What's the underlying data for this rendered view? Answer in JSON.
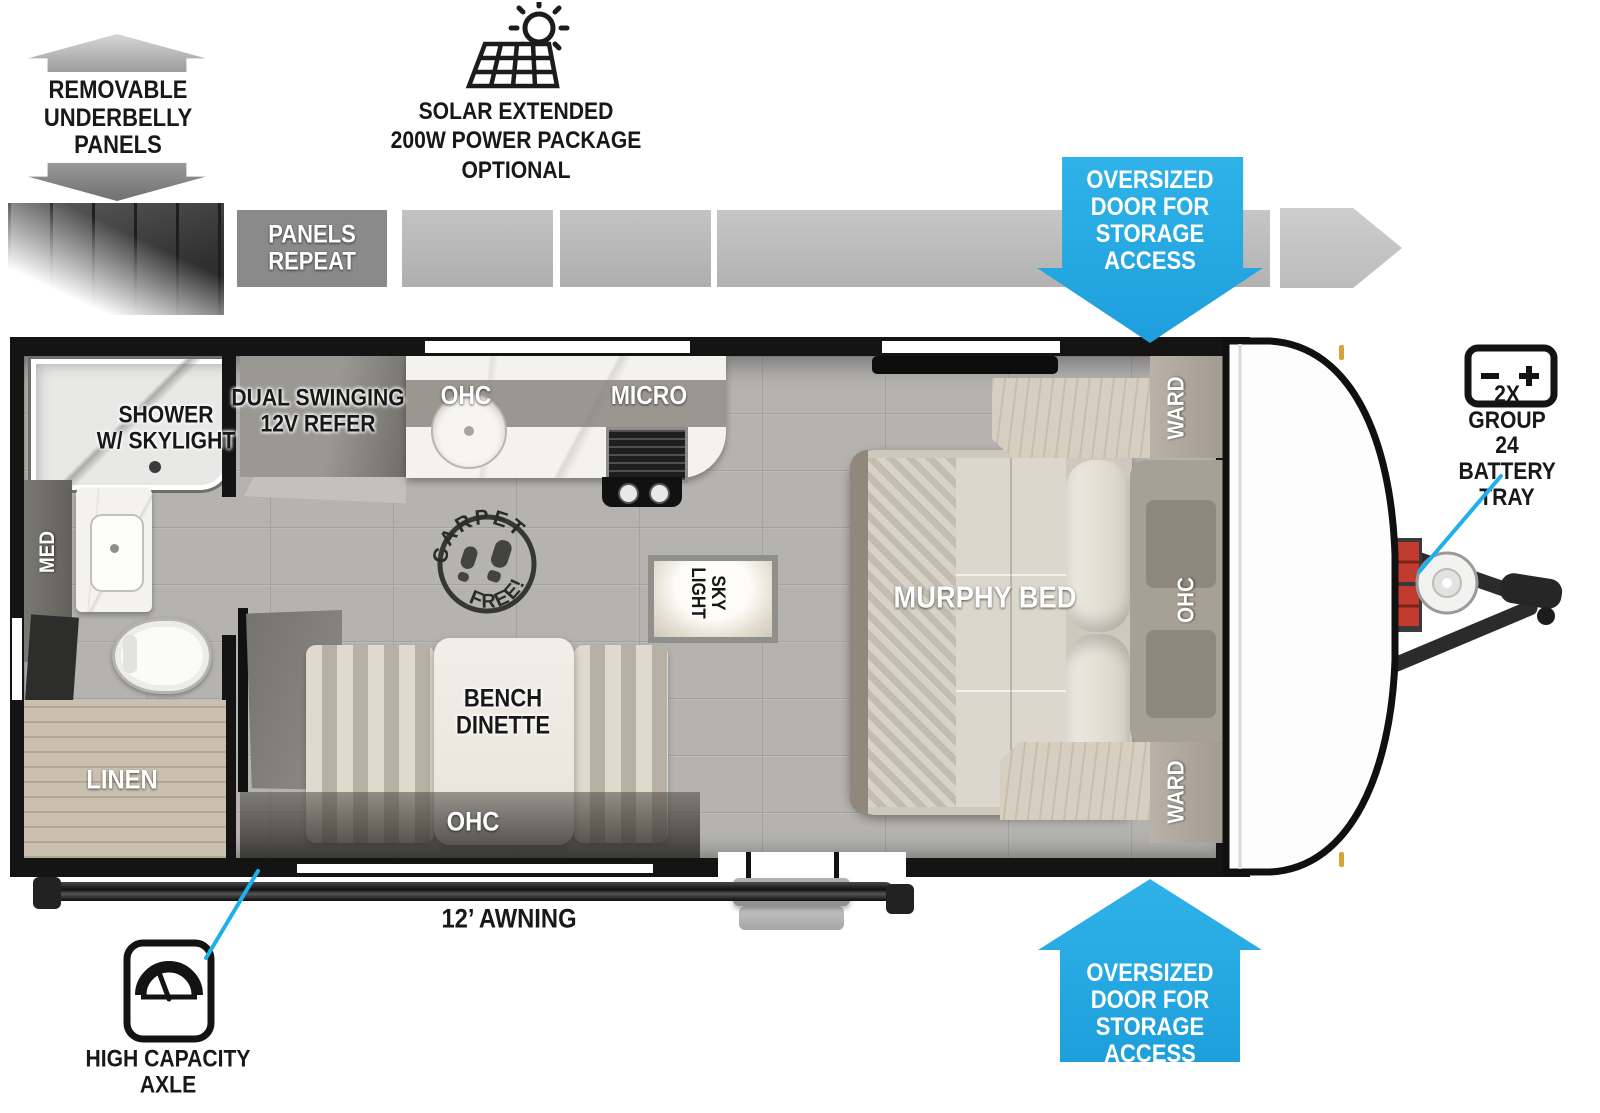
{
  "colors": {
    "accent_blue": "#29ABE2",
    "callout_line": "#1FB0EC"
  },
  "callouts": {
    "underbelly": {
      "label": "REMOVABLE\nUNDERBELLY\nPANELS"
    },
    "panels_repeat": {
      "label": "PANELS\nREPEAT"
    },
    "solar": {
      "label": "SOLAR EXTENDED\n200W POWER PACKAGE\nOPTIONAL"
    },
    "oversized_door_top": {
      "label": "OVERSIZED\nDOOR FOR\nSTORAGE\nACCESS"
    },
    "oversized_door_bottom": {
      "label": "OVERSIZED\nDOOR FOR\nSTORAGE\nACCESS"
    },
    "battery": {
      "label": "2X GROUP 24\nBATTERY TRAY"
    },
    "awning": {
      "label": "12’ AWNING"
    },
    "axle": {
      "label": "HIGH CAPACITY\nAXLE"
    },
    "carpet_free": {
      "top": "CARPET",
      "bottom": "FREE!"
    }
  },
  "floorplan": {
    "labels": {
      "shower": "SHOWER\nW/ SKYLIGHT",
      "med": "MED",
      "linen": "LINEN",
      "refer": "DUAL SWINGING\n12V REFER",
      "kitchen_ohc": "OHC",
      "micro": "MICRO",
      "skylight": "SKY\nLIGHT",
      "dinette": "BENCH\nDINETTE",
      "dinette_ohc": "OHC",
      "murphy_bed": "MURPHY BED",
      "ward_top": "WARD",
      "ward_bottom": "WARD",
      "bed_ohc": "OHC"
    }
  }
}
